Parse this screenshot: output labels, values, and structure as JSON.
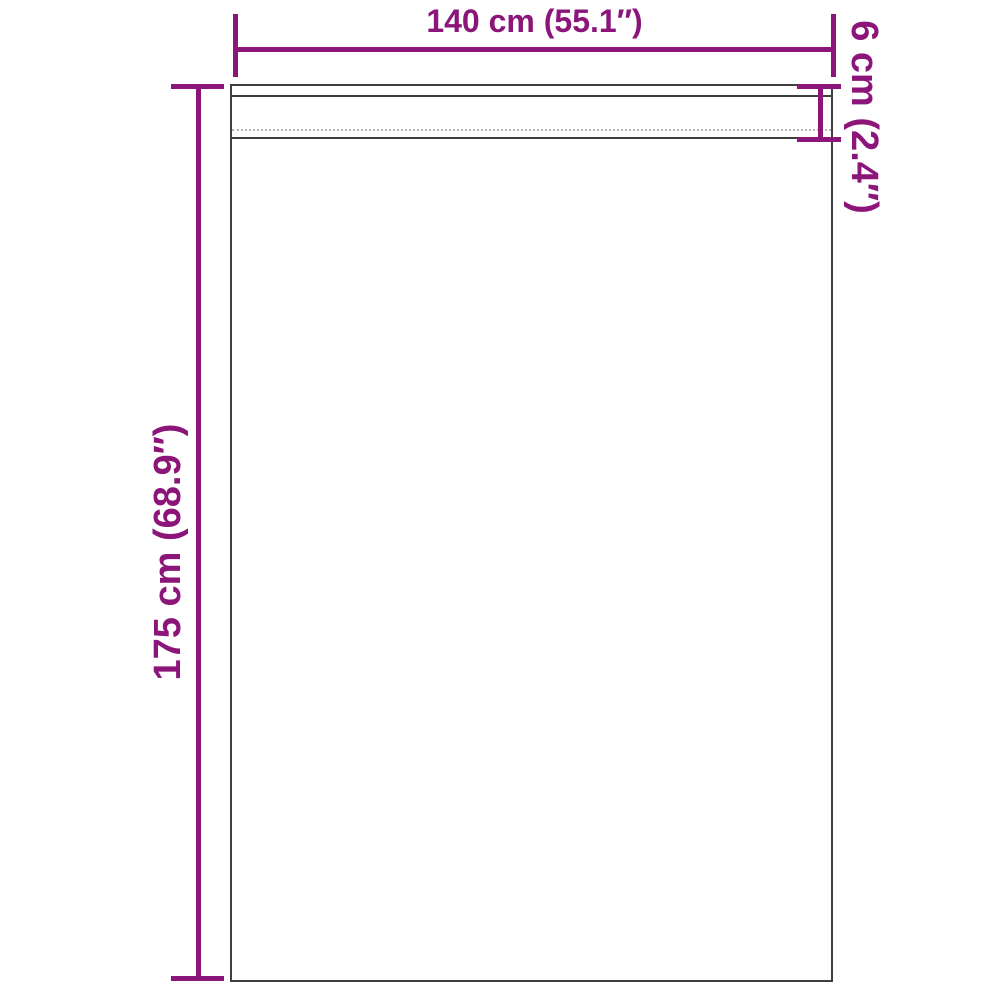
{
  "diagram": {
    "subject": "curtain-panel-dimension-diagram",
    "background_color": "#ffffff",
    "accent_color": "#8b1578",
    "outline_color": "#3f3f3e",
    "dimensions": {
      "width": {
        "label": "140 cm (55.1″)",
        "cm": 140,
        "inches": 55.1
      },
      "height": {
        "label": "175 cm (68.9″)",
        "cm": 175,
        "inches": 68.9
      },
      "header_height": {
        "label": "6 cm (2.4″)",
        "cm": 6,
        "inches": 2.4
      }
    }
  }
}
